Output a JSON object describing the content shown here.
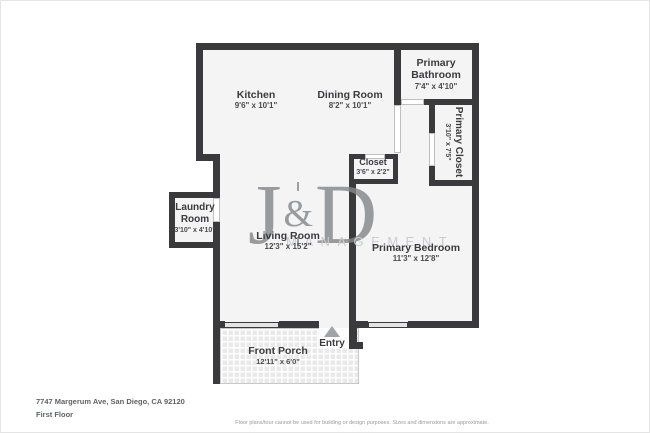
{
  "footer": {
    "address": "7747 Margerum Ave, San Diego, CA 92120",
    "floor_label": "First Floor",
    "disclaimer": "Floor plans/tour cannot be used for building or design purposes. Sizes and dimensions are approximate."
  },
  "watermark": {
    "letter_left": "J",
    "ampersand": "&",
    "letter_right": "D",
    "subtitle": "MANAGEMENT"
  },
  "rooms": {
    "kitchen": {
      "name": "Kitchen",
      "dims": "9'6\" x 10'1\""
    },
    "dining": {
      "name": "Dining Room",
      "dims": "8'2\" x 10'1\""
    },
    "primary_bathroom": {
      "name_line1": "Primary",
      "name_line2": "Bathroom",
      "dims": "7'4\" x 4'10\""
    },
    "primary_closet": {
      "name": "Primary Closet",
      "dims": "3'10\" x 7'5\""
    },
    "closet": {
      "name": "Closet",
      "dims": "3'6\" x 2'2\""
    },
    "laundry": {
      "name_line1": "Laundry",
      "name_line2": "Room",
      "dims": "3'10\" x 4'10\""
    },
    "living": {
      "name": "Living Room",
      "dims": "12'3\" x 15'2\""
    },
    "primary_bedroom": {
      "name": "Primary Bedroom",
      "dims": "11'3\" x 12'8\""
    },
    "front_porch": {
      "name": "Front Porch",
      "dims": "12'11\" x 6'0\""
    },
    "entry": {
      "name": "Entry"
    }
  },
  "colors": {
    "wall": "#3a3a3c",
    "floor": "#f4f4f5",
    "watermark": "#84888b",
    "watermark_subtitle": "#caccce",
    "entry_arrow": "#a1a4a6"
  }
}
